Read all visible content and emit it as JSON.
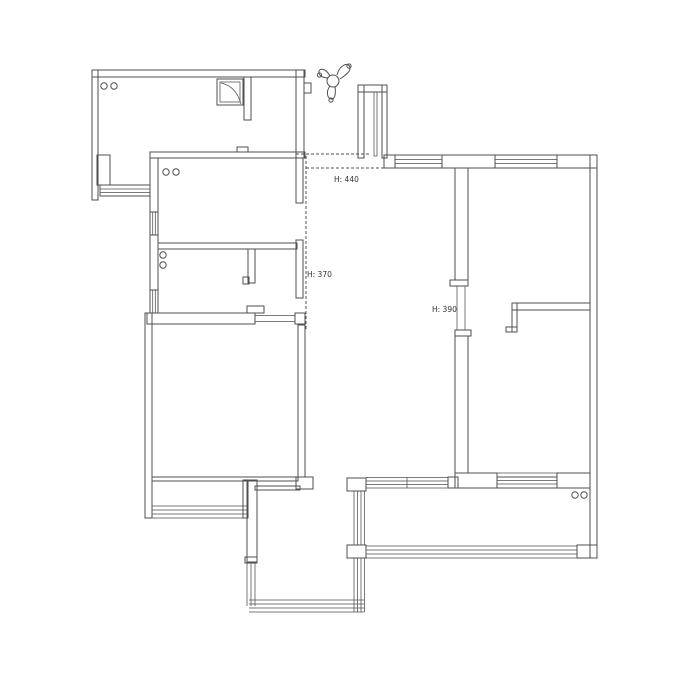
{
  "page": {
    "background": "#ffffff",
    "line_color": "#4f4f4f",
    "text_color": "#333333"
  },
  "floor_plan": {
    "height_labels": [
      {
        "id": "h440",
        "text": "H: 440"
      },
      {
        "id": "h370",
        "text": "H: 370"
      },
      {
        "id": "h390",
        "text": "H: 390"
      }
    ],
    "icons": [
      {
        "name": "compass-north-arrow-icon"
      },
      {
        "name": "fixture-circle-pair"
      },
      {
        "name": "fridge-symbol"
      }
    ]
  }
}
